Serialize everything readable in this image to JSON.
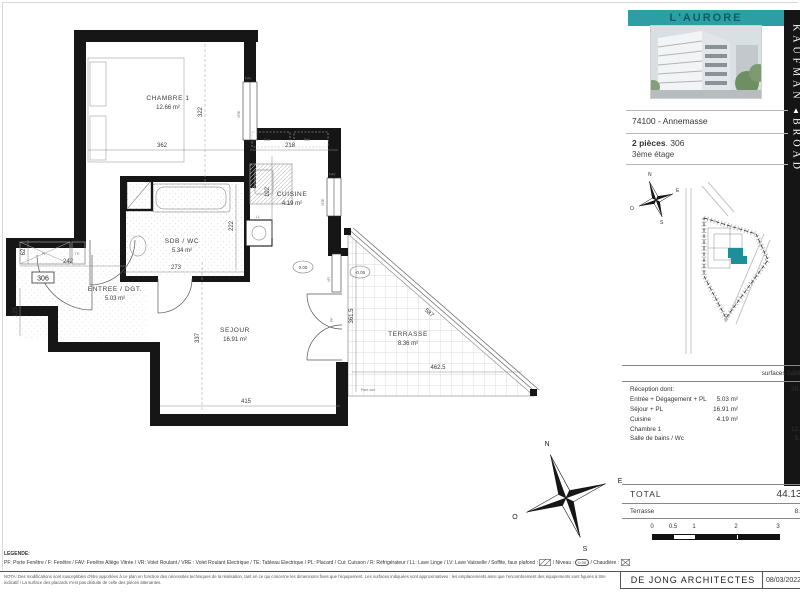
{
  "project": {
    "title": "L'AURORE",
    "developer_top": "KAUFMAN",
    "developer_logo": "▲",
    "developer_bottom": "BROAD",
    "location": "74100 - Annemasse",
    "unit_type": "2 pièces",
    "unit_separator": ". ",
    "unit_number": "306",
    "floor": "3ème étage"
  },
  "colors": {
    "accent_teal": "#2D9FA4",
    "accent_teal_dark": "#0A5F66",
    "unit_marker_teal": "#1E8F98"
  },
  "plan": {
    "rooms": {
      "chambre": {
        "name": "CHAMBRE 1",
        "area": "12.66 m²"
      },
      "cuisine": {
        "name": "CUISINE",
        "area": "4.19 m²"
      },
      "sdb": {
        "name": "SDB / WC",
        "area": "5.34 m²"
      },
      "entree": {
        "name": "ENTREE / DGT.",
        "area": "5.03 m²"
      },
      "sejour": {
        "name": "SEJOUR",
        "area": "16.91 m²"
      },
      "terrasse": {
        "name": "TERRASSE",
        "area": "8.36 m²"
      }
    },
    "dims": {
      "chambre_width": "362",
      "chambre_depth": "322",
      "cuisine_width": "218",
      "cuisine_depth": "192",
      "entree_width": "242",
      "niche_depth": "62",
      "entree_side": "125",
      "sdb_width": "273",
      "sdb_depth": "222",
      "sejour_depth": "337",
      "sejour_width": "415",
      "terrasse_depth": "361.5",
      "terrasse_width": "462.5",
      "terrasse_hypotenuse": "587"
    },
    "labels": {
      "door_number": "306",
      "fav": "FAV",
      "vre": "VRE",
      "vr": "VR",
      "pf": "PF",
      "pl": "PL",
      "te": "TE",
      "ll": "LL",
      "cuisson": "Cui.",
      "refrigerateur": "Réf.",
      "level_interior": "0.00",
      "level_terrasse": "-0.05",
      "pare_vue": "Pare-vue"
    },
    "compass": {
      "n": "N",
      "e": "E",
      "s": "S",
      "w": "O"
    }
  },
  "surfaces_table": {
    "header": "surfaces habitables",
    "rows": [
      {
        "label": "Réception dont:",
        "mid": "",
        "right": "26.13 m²"
      },
      {
        "label": "Entrée + Dégagement + PL",
        "mid": "5.03 m²",
        "right": ""
      },
      {
        "label": "Séjour + PL",
        "mid": "16.91 m²",
        "right": ""
      },
      {
        "label": "Cuisine",
        "mid": "4.19 m²",
        "right": ""
      },
      {
        "label": "Chambre 1",
        "mid": "",
        "right": "12.66 m²"
      },
      {
        "label": "Salle de bains / Wc",
        "mid": "",
        "right": "5.34 m²"
      }
    ],
    "total_label": "TOTAL",
    "total_value": "44.13 m²",
    "terrace_label": "Terrasse",
    "terrace_value": "8.36 m²"
  },
  "scale_bar": {
    "labels": [
      "0",
      "0.5",
      "1",
      "2",
      "3"
    ]
  },
  "legend": {
    "title": "LEGENDE:",
    "abbreviations": "PF: Porte Fenêtre / F: Fenêtre / FAV: Fenêtre Allège Vitrée / VR: Volet Roulant / VRE : Volet Roulant Electrique / TE: Tableau Electrique / PL: Placard / Cui: Cuisson / R: Réfrigérateur / LL: Lave Linge / LV: Lave Vaisselle / Soffite, faux plafond :",
    "niveau_label": "/ Niveau :",
    "niveau_value": "0.00",
    "chaudiere_label": "/ Chaudière :",
    "nota": "NOTA: Des modifications sont susceptibles d'être apportées à ce plan en fonction des nécessités techniques de la réalisation, tant en ce qui concerne les dimensions fixes que l'équipement. Les surfaces indiquées sont approximatives ; les emplacements ainsi que l'encombrement des équipements sont figurés à titre indicatif / La surface des placards n'est pas déduite de celle des pièces attenantes."
  },
  "footer": {
    "architect": "DE JONG ARCHITECTES",
    "date": "08/03/2022 -"
  }
}
